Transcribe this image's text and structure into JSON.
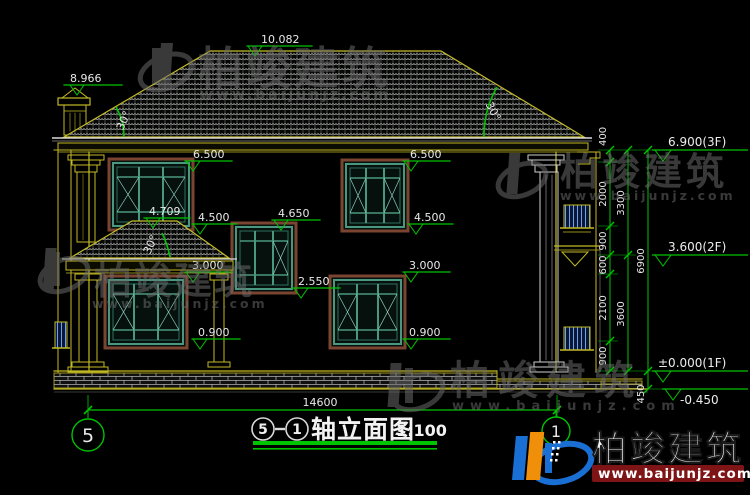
{
  "colors": {
    "background": "#000000",
    "dimension_green": "#00c400",
    "line_yellow": "#c3ba25",
    "text_white": "#e8e8e8",
    "window_teal": "#49977f",
    "window_frame_brown": "#7a4430",
    "side_window_blue": "#6fa0ec",
    "watermark_gray": "#6d6d6d",
    "logo_blue": "#1a6fd4",
    "logo_orange": "#f0900a",
    "logo_url_band_red": "#7e1416"
  },
  "levels": {
    "ridge": "10.082",
    "chimney": "8.966",
    "win2f_left_top": "6.500",
    "win2f_left_bottom": "4.500",
    "porch_ridge": "4.709",
    "porch_eave": "3.000",
    "stair_win_top": "4.650",
    "stair_win_bottom": "2.550",
    "win2f_right_top": "6.500",
    "win2f_right_bottom": "4.500",
    "win1f_right_top": "3.000",
    "win1f_left_sill": "0.900",
    "win1f_right_sill": "0.900"
  },
  "angles": {
    "main_roof_left": "30°",
    "main_roof_right": "30°",
    "porch_roof": "30°"
  },
  "floor_flags": {
    "f3": "6.900(3F)",
    "f2": "3.600(2F)",
    "f1": "±0.000(1F)",
    "ground": "-0.450"
  },
  "dims": {
    "col1": [
      "400",
      "2000",
      "900",
      "600",
      "2100",
      "900"
    ],
    "col2": [
      "3300",
      "3600"
    ],
    "col3": [
      "6900"
    ],
    "below": "450",
    "width": "14600"
  },
  "axes": {
    "left": "5",
    "right": "1"
  },
  "title": {
    "axis_start": "5",
    "axis_end": "1",
    "name": "轴立面图",
    "scale": "1:100"
  },
  "watermark": {
    "brand": "柏竣建筑",
    "url": "www.baijunjz.com"
  },
  "logo": {
    "brand": "柏竣建筑",
    "url": "www.baijunjz.com"
  }
}
